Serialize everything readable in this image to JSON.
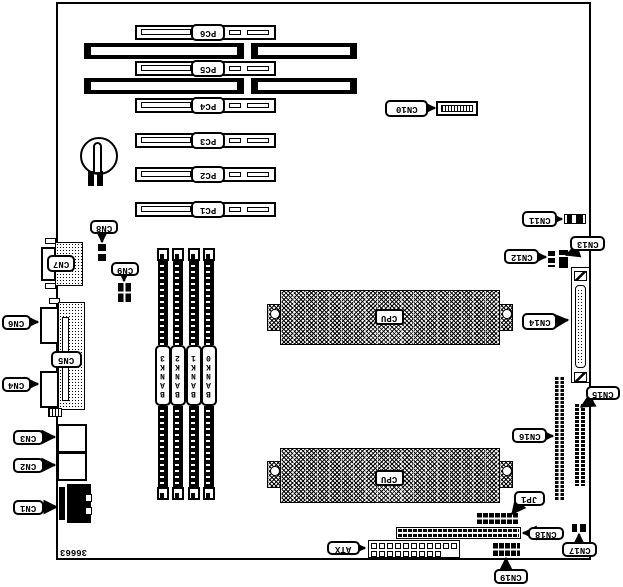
{
  "diagram": {
    "type": "motherboard-layout",
    "part_number": "36663",
    "cpu_label": "CPU",
    "atx_label": "ATX",
    "jumper_label": "JP1",
    "pci_slots": [
      "PC1",
      "PC2",
      "PC3",
      "PC4",
      "PC5",
      "PC6"
    ],
    "memory_banks": [
      "BANK0",
      "BANK1",
      "BANK2",
      "BANK3"
    ],
    "connectors": {
      "cn1": "CN1",
      "cn2": "CN2",
      "cn3": "CN3",
      "cn4": "CN4",
      "cn5": "CN5",
      "cn6": "CN6",
      "cn7": "CN7",
      "cn8": "CN8",
      "cn9": "CN9",
      "cn10": "CN10",
      "cn11": "CN11",
      "cn12": "CN12",
      "cn13": "CN13",
      "cn14": "CN14",
      "cn15": "CN15",
      "cn16": "CN16",
      "cn17": "CN17",
      "cn18": "CN18",
      "cn19": "CN19"
    },
    "colors": {
      "line": "#000000",
      "background": "#ffffff"
    }
  }
}
